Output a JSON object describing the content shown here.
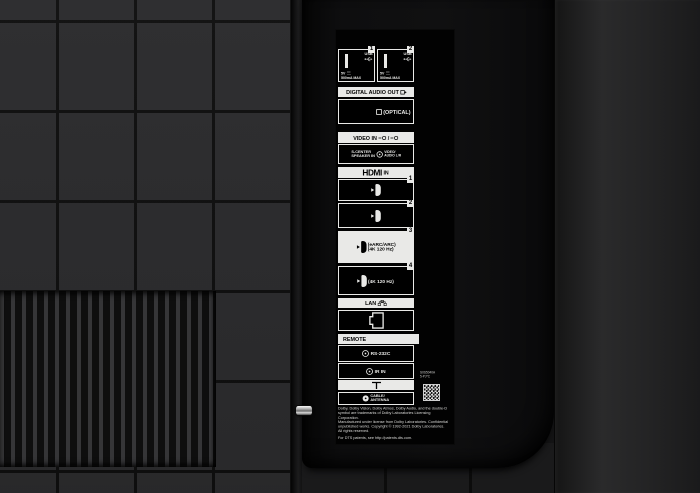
{
  "colors": {
    "tile": "#2b2b2d",
    "tile_gap": "#0f0f0f",
    "bay": "#0e0e0f",
    "right_panel": "#2a2a2b",
    "panel_background": "#020202",
    "label_white": "#e9e9e7"
  },
  "panel": {
    "usb": {
      "ports": [
        {
          "number": "1",
          "label": "USB",
          "voltage": "5V",
          "current": "500mA MAX"
        },
        {
          "number": "2",
          "label": "USB",
          "voltage": "5V",
          "current": "500mA MAX"
        }
      ]
    },
    "digital_audio_out": {
      "label": "DIGITAL AUDIO OUT",
      "optical": "(OPTICAL)"
    },
    "video_in": {
      "label": "VIDEO IN",
      "separator": "/"
    },
    "s_center": {
      "line1": "S-CENTER",
      "line2": "SPEAKER IN",
      "right1": "VIDEO/",
      "right2": "AUDIO L/R"
    },
    "hdmi": {
      "logo": "HDMI",
      "suffix": "IN",
      "ports": [
        {
          "number": "1"
        },
        {
          "number": "2"
        },
        {
          "number": "3",
          "line1": "(eARC/ARC)",
          "line2": "(4K 120 Hz)"
        },
        {
          "number": "4",
          "line1": "(4K 120 Hz)"
        }
      ]
    },
    "lan": {
      "label": "LAN"
    },
    "remote": {
      "label": "REMOTE",
      "rs232c": "RS-232C",
      "ir_in": "IR IN"
    },
    "antenna": {
      "line1": "CABLE/",
      "line2": "ANTENNA"
    },
    "sticker": {
      "line1": "S0S5040A",
      "line2": "5-PJ*C"
    },
    "legal": {
      "p1": "Dolby, Dolby Vision, Dolby Atmos, Dolby Audio, and the double-D symbol are trademarks of Dolby Laboratories Licensing Corporation.",
      "p2": "Manufactured under license from Dolby Laboratories. Confidential unpublished works. Copyright © 1992-2021 Dolby Laboratories. All rights reserved.",
      "p3": "For DTS patents, see http://patents.dts.com."
    }
  }
}
